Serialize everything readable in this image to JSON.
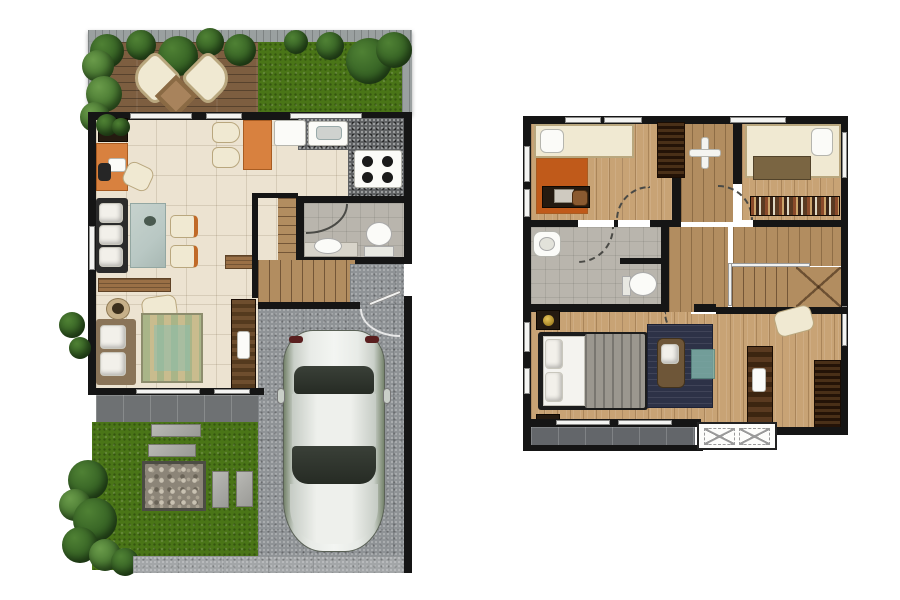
{
  "page": {
    "title": "Two-storey house floor plans, top-view 3D render",
    "description": "Ground floor plan on the left, second floor plan on the right, white background",
    "canvas": {
      "width": 900,
      "height": 600
    }
  },
  "colors": {
    "background": "#ffffff",
    "wall": "#151515",
    "fence_gray": "#9aa0a0",
    "deck_wood": "#7d5e40",
    "lawn_green": "#4a7517",
    "foliage_dark": "#2f5a20",
    "foliage_light": "#4f8134",
    "tile_cream": "#ece3d1",
    "wood_light": "#c8a375",
    "wood_mid": "#b28d60",
    "granite_gray": "#5e6062",
    "concrete_gray": "#8f9396",
    "paver_dark": "#6e7173",
    "bath_tile": "#b9b5ad",
    "accent_orange": "#d8813f",
    "cream": "#f0e9d2",
    "sofa_frame": "#2b2b2b",
    "glass_teal": "#b9c8c4",
    "rug_green": "#a9b588",
    "rug_tan": "#c9bc8e",
    "rug_navy": "#2d3247",
    "ottoman_teal": "#7fb0a8",
    "car_silver": "#d6dad6",
    "car_glass": "#262b24",
    "wardrobe_dark": "#3a2517",
    "blanket_gray": "#9b978f",
    "blanket_brown": "#7a6542",
    "lamp_gold": "#8a6a10"
  },
  "plans": [
    {
      "name": "ground-floor",
      "position": "left",
      "rooms": [
        "terrace-deck",
        "front-lawn",
        "living-room",
        "dining-area",
        "kitchen",
        "bathroom",
        "staircase",
        "garage",
        "rear-patio",
        "garden",
        "driveway"
      ],
      "objects": [
        "lounge-chairs",
        "outdoor-side-table",
        "shrubs",
        "planter-box",
        "work-desk",
        "desk-chairs",
        "sofa",
        "glass-coffee-table",
        "accent-chairs",
        "dining-table",
        "dining-chairs",
        "kitchen-counter",
        "kitchen-sink",
        "cooktop",
        "toilet",
        "wash-basin",
        "sideboard",
        "tv-cabinet",
        "loveseat",
        "armchair",
        "striped-area-rug",
        "side-table",
        "car",
        "stepping-stones",
        "pebble-pad"
      ]
    },
    {
      "name": "second-floor",
      "position": "right",
      "rooms": [
        "bedroom-1",
        "bedroom-2",
        "master-bedroom",
        "bathroom",
        "hallway",
        "staircase",
        "family-area",
        "balcony",
        "service-ledge"
      ],
      "objects": [
        "single-bed",
        "study-desk",
        "wardrobe",
        "ceiling-lamp",
        "double-bed",
        "bookshelf",
        "wash-basin",
        "toilet",
        "nightstands",
        "table-lamps",
        "armchair",
        "ottoman",
        "navy-area-rug",
        "desk-chair",
        "console-table",
        "condenser-units"
      ]
    }
  ]
}
